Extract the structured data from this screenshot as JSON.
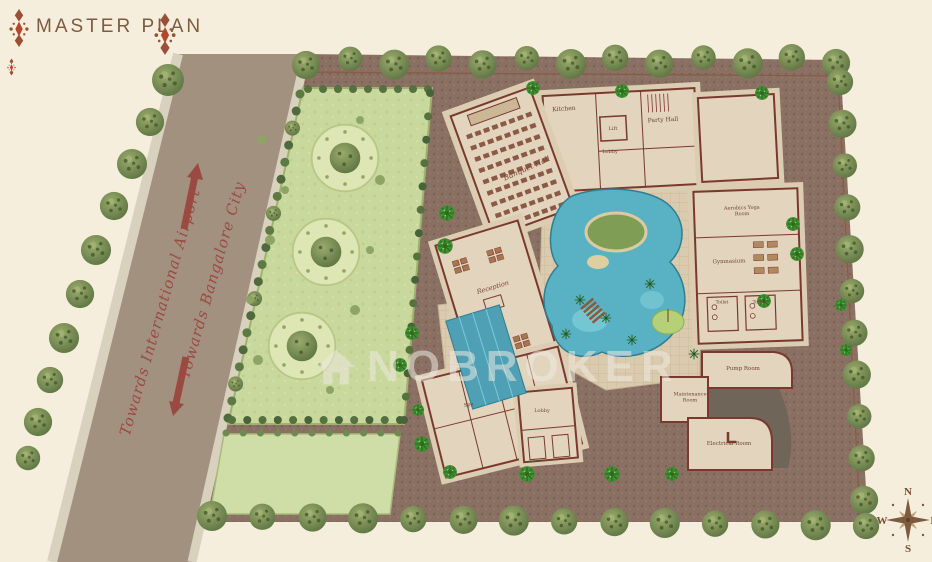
{
  "page": {
    "title": "MASTER PLAN"
  },
  "watermark": {
    "brand": "NOBROKER"
  },
  "road": {
    "airport_label": "Towards International Airport",
    "city_label": "Towards Bangalore City"
  },
  "compass": {
    "north": "N",
    "south": "S",
    "east": "E",
    "west": "W"
  },
  "rooms": {
    "kitchen": "Kitchen",
    "lift": "Lift",
    "lobby_upper": "Lobby",
    "party_hall": "Party Hall",
    "banquet_hall": "Banquet Hall",
    "reception": "Reception",
    "aerobics": "Aerobics Yoga Room",
    "gymnasium": "Gymnasium",
    "toilet": "Toilet",
    "spa": "Spa",
    "lobby_lower": "Lobby",
    "pump_room": "Pump Room",
    "maintenance_room": "Maintenance Room",
    "electrical_room": "Electrical Room"
  },
  "colors": {
    "background": "#f5eedc",
    "paving": "#8a7062",
    "road": "#a39180",
    "lawn": "#c9d89c",
    "water": "#58b2c4",
    "wall": "#7a392f",
    "accent": "#9b4a42",
    "title": "#7d5a40",
    "watermark": "rgba(236,233,224,0.55)"
  }
}
